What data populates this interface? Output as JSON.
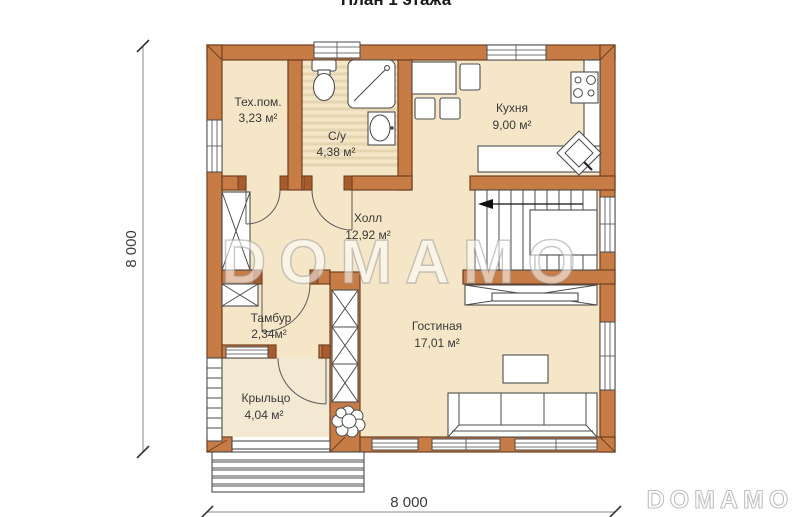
{
  "page": {
    "clipped_heading": "План 1 этажа"
  },
  "plan": {
    "type": "floor_plan",
    "rooms": [
      {
        "id": "tech",
        "name": "Тех.пом.",
        "area": "3,23 м²"
      },
      {
        "id": "bath",
        "name": "С/у",
        "area": "4,38 м²"
      },
      {
        "id": "kitchen",
        "name": "Кухня",
        "area": "9,00 м²"
      },
      {
        "id": "hall",
        "name": "Холл",
        "area": "12,92 м²"
      },
      {
        "id": "tambour",
        "name": "Тамбур",
        "area": "2,34м²"
      },
      {
        "id": "living",
        "name": "Гостиная",
        "area": "17,01 м²"
      },
      {
        "id": "porch",
        "name": "Крыльцо",
        "area": "4,04 м²"
      }
    ],
    "dimensions": {
      "height_label": "8 000",
      "width_label": "8 000"
    },
    "watermark_text": "DOMAMO",
    "logo_text": "DOMAMO",
    "fixtures": [
      "toilet",
      "shower-cabin",
      "washbasin",
      "dining-table",
      "chairs",
      "stove",
      "kitchen-counter",
      "corner-sink",
      "staircase",
      "wardrobes",
      "tv-stand",
      "coffee-table",
      "sofa",
      "plant",
      "porch-steps",
      "porch-railing"
    ]
  },
  "palette": {
    "wall_fill": "#c87c45",
    "wall_stroke": "#6e3f20",
    "wall_dark": "#a85c2e",
    "room_fill": "#f4e6c7",
    "porch_fill": "#f3e9d2",
    "bath_stripe": "#e4d5b0",
    "furniture_stroke": "#4d4d4d",
    "label_color": "#3a3a3a",
    "dim_color": "#3c3c3c",
    "watermark_stroke": "#9b9b9b",
    "logo_stroke": "#bfbfbf"
  }
}
